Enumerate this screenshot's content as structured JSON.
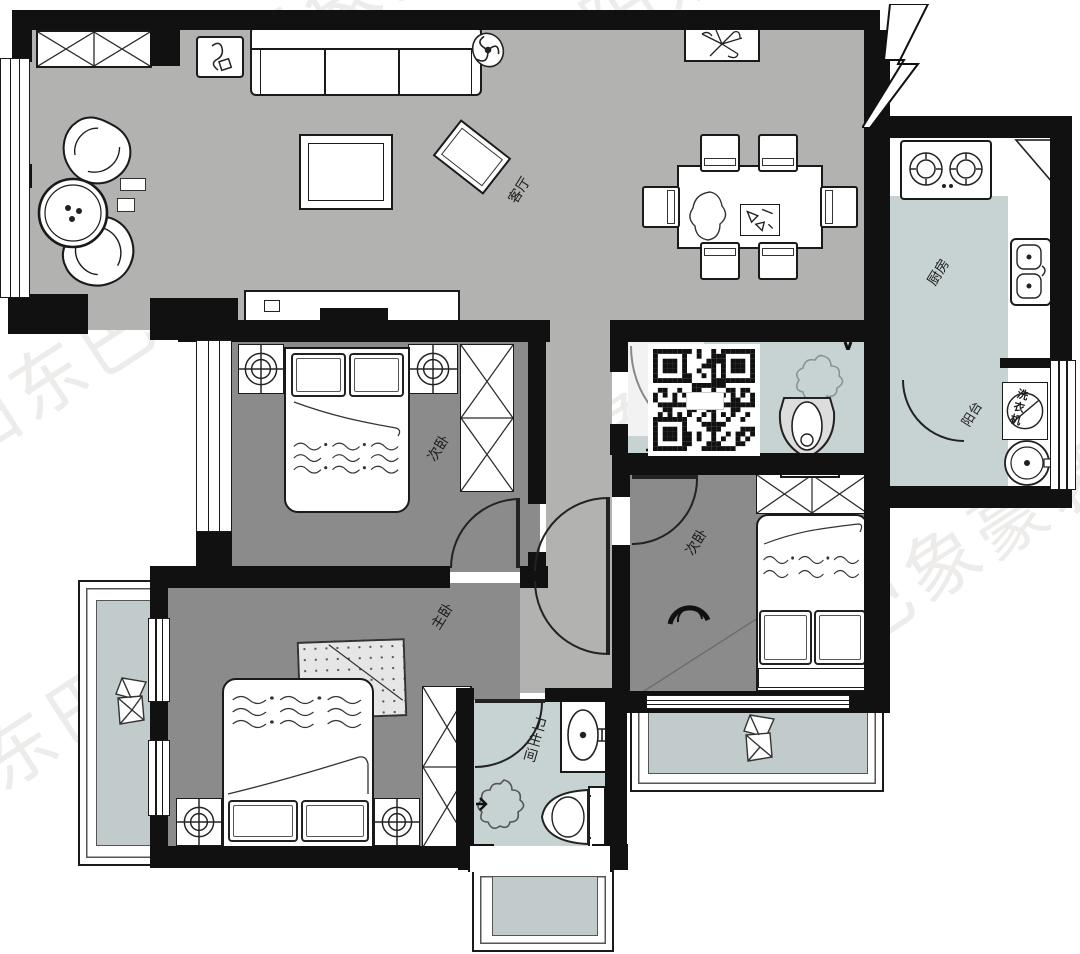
{
  "watermark": {
    "text": "衡阳东巴象豪装工厂店"
  },
  "rooms": {
    "living_room": {
      "label": "客厅"
    },
    "kitchen": {
      "label": "厨房"
    },
    "balcony": {
      "label": "阳台"
    },
    "secondary_bedroom_top": {
      "label": "次卧"
    },
    "secondary_bedroom_right": {
      "label": "次卧"
    },
    "master_bedroom": {
      "label": "主卧"
    },
    "bathroom": {
      "label": "卫生间"
    }
  },
  "appliances": {
    "washing_machine": {
      "label": "洗衣机"
    }
  },
  "colors": {
    "wall": "#111111",
    "floor_living": "#b2b2b0",
    "floor_bedroom": "#8b8b8b",
    "floor_wet": "#c7d2d3",
    "floor_bay": "#c2cbcc",
    "watermark_dark": "#e6e4e1",
    "watermark_light": "rgba(255,255,255,0.30)"
  }
}
